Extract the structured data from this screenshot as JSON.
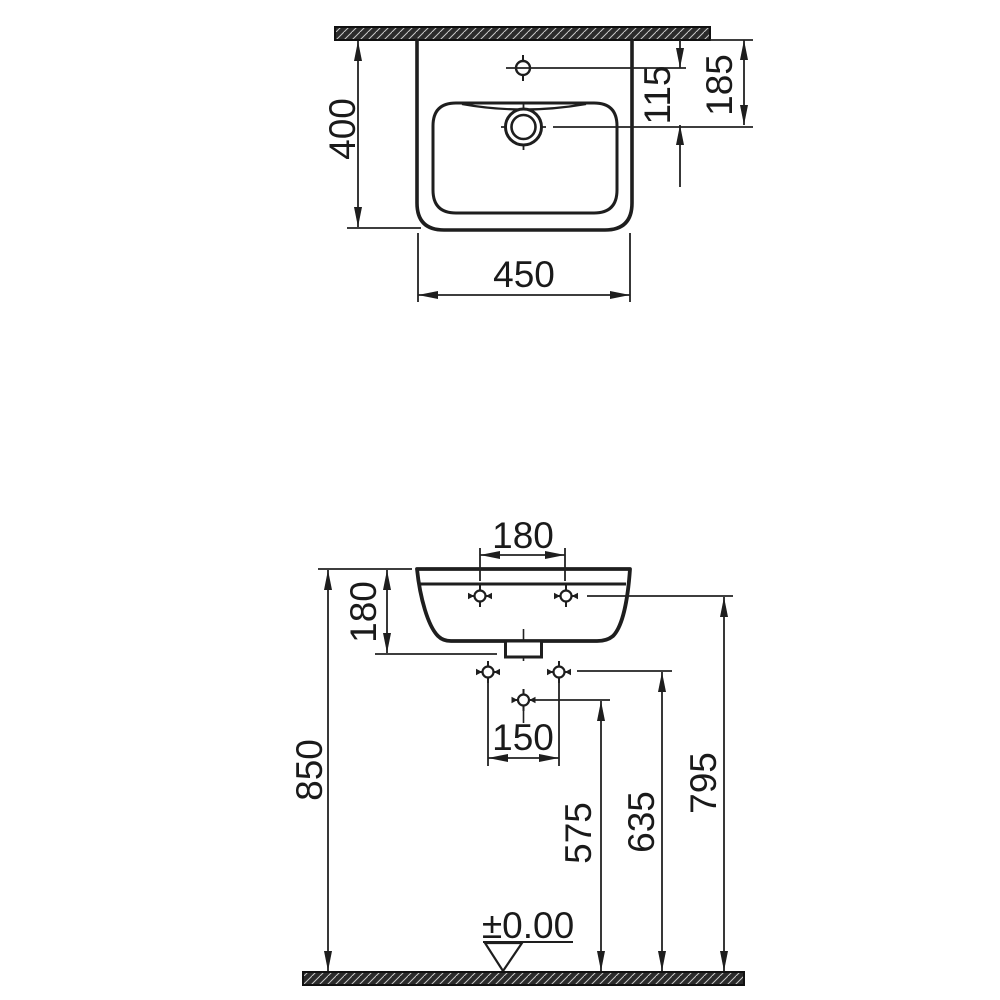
{
  "drawing": {
    "type": "technical-dimension-drawing",
    "subject": "wall-hung washbasin, plan view and front elevation",
    "colors": {
      "line": "#1e1e1e",
      "background": "#ffffff",
      "hatch_dark": "#2b2b2b",
      "hatch_light": "#c8c8c8"
    },
    "top_view": {
      "depth": "400",
      "width": "450",
      "tap_to_faucet_offset": "115",
      "wall_to_faucet_offset": "185"
    },
    "front_view": {
      "hole_spacing": "180",
      "basin_height": "180",
      "rim_height": "850",
      "fixing_spacing": "150",
      "drain_height": "575",
      "fixing_height": "635",
      "hole_height": "795",
      "datum": "±0.00"
    }
  }
}
